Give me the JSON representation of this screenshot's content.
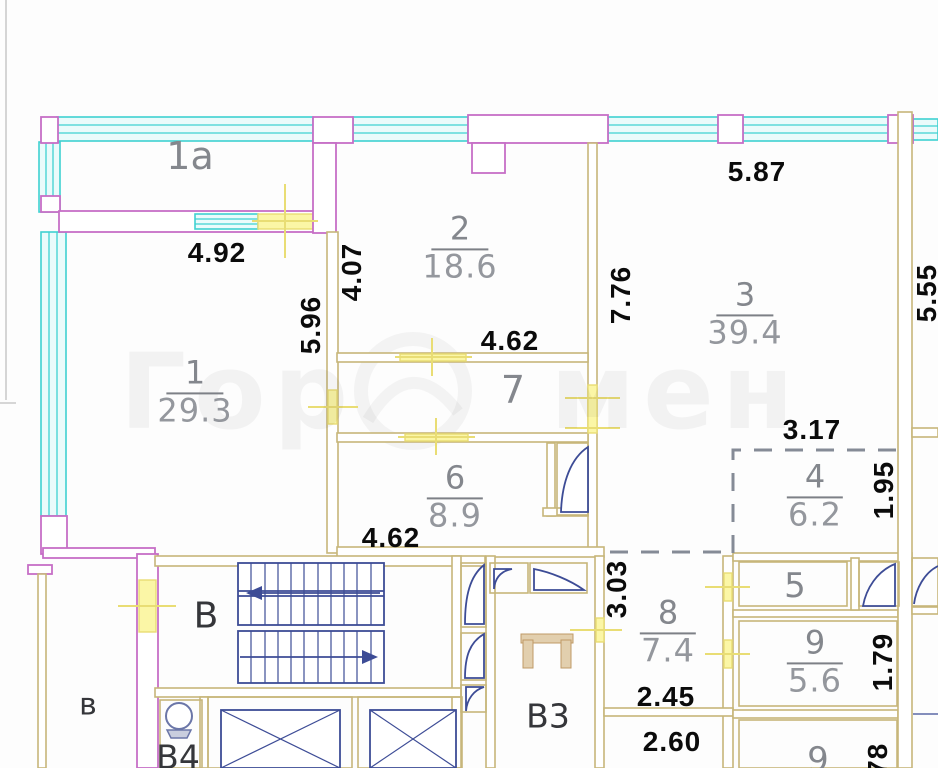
{
  "watermark": {
    "left": "Гор",
    "right": "мен"
  },
  "rooms": {
    "balcony": {
      "number": "1а"
    },
    "r1": {
      "number": "1",
      "area": "29.3"
    },
    "r2": {
      "number": "2",
      "area": "18.6"
    },
    "r3": {
      "number": "3",
      "area": "39.4"
    },
    "r4": {
      "number": "4",
      "area": "6.2"
    },
    "r5": {
      "number": "5"
    },
    "r6": {
      "number": "6",
      "area": "8.9"
    },
    "r7": {
      "number": "7"
    },
    "r8": {
      "number": "8",
      "area": "7.4"
    },
    "r9": {
      "number": "9",
      "area": "5.6"
    },
    "r9b": {
      "number": "9"
    }
  },
  "service_labels": {
    "stair_hall": "В",
    "entry": "в",
    "lobby": "В3",
    "wc": "В4"
  },
  "dimensions": {
    "balcony_width": "4.92",
    "room1_height": "5.96",
    "room2_left": "4.07",
    "room2_width": "4.62",
    "room6_width": "4.62",
    "room3_width": "5.87",
    "room3_height": "7.76",
    "neighbor_height": "5.55",
    "room4_width": "3.17",
    "room4_height": "1.95",
    "room8_height": "3.03",
    "room8_width": "2.45",
    "room8b_width": "2.60",
    "room9_height": "1.79",
    "room9b_height": "1.78"
  },
  "colors": {
    "outer_wall": "#c66fc6",
    "window": "#46cfcf",
    "partition": "#c7b67a",
    "opening_marker": "#f1e88d",
    "fixture": "#3d4c96"
  }
}
